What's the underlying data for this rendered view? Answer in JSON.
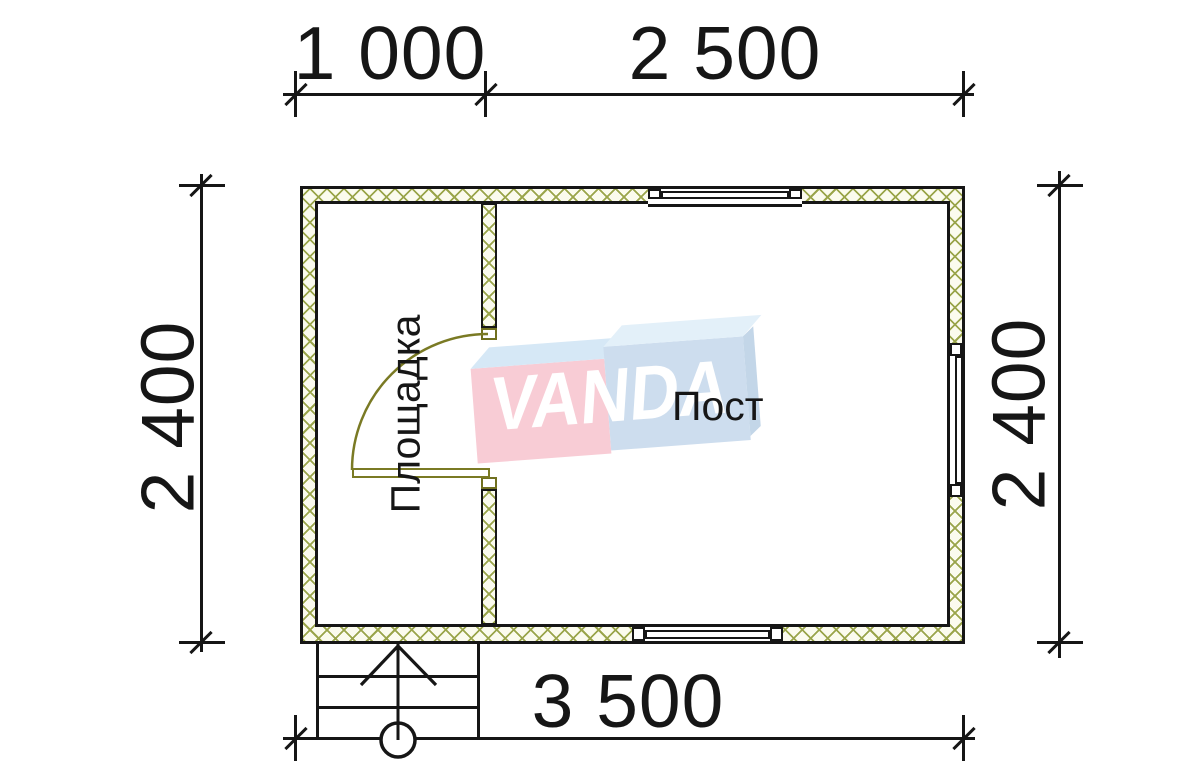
{
  "drawing": {
    "type": "architectural floor plan",
    "dimensions": {
      "top_left": "1 000",
      "top_right": "2 500",
      "left": "2 400",
      "right": "2 400",
      "bottom": "3 500"
    },
    "rooms": {
      "porch": "Площадка",
      "main": "Пост"
    },
    "watermark": {
      "brand": "VANDA"
    },
    "colors": {
      "line": "#161616",
      "wall_hatch": "#9aa54b",
      "wall_fill": "#fbfbee",
      "door": "#7a7a24",
      "logo_pink": "#f8ccd5",
      "logo_blue": "#cdddee",
      "logo_bevel_left": "#d6e8f6",
      "logo_bevel_right": "#e3f0f9"
    }
  }
}
